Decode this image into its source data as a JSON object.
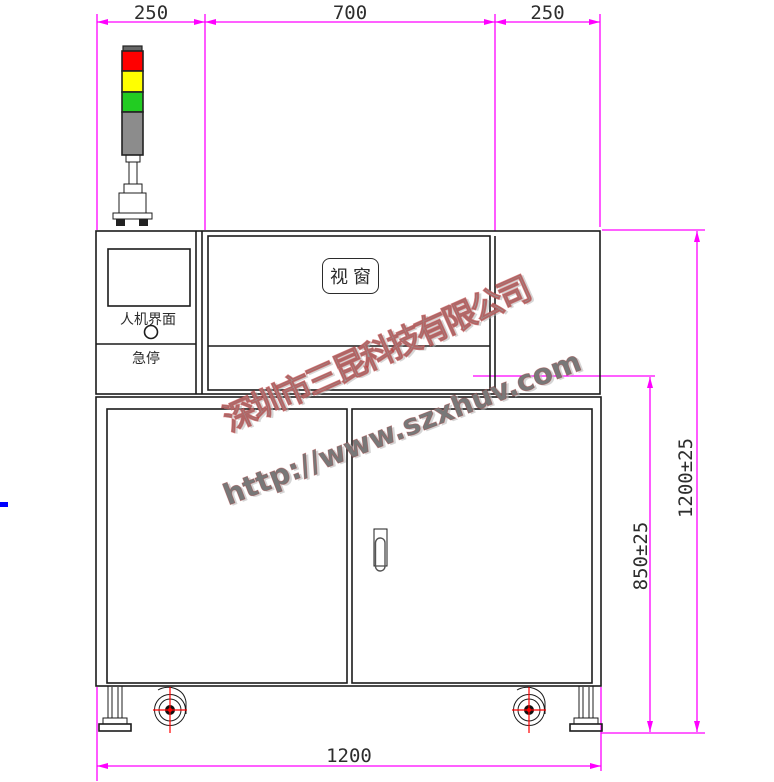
{
  "title": "UV machine front view CAD drawing",
  "colors": {
    "dim": "#FF00FF",
    "line": "#1c1c1c",
    "text": "#2e2e2e",
    "red": "#FF0000",
    "yellow": "#FFFF00",
    "green": "#22CC22",
    "gray": "#8C8C8C",
    "blue": "#0000FF",
    "watermark": "#9b9b9b"
  },
  "dimensions": {
    "top_left": "250",
    "top_mid": "700",
    "top_right": "250",
    "right_outer": "1200±25",
    "right_inner": "850±25",
    "bottom": "1200"
  },
  "labels": {
    "window": "视窗",
    "hmi": "人机界面",
    "estop": "急停"
  },
  "watermark": {
    "company": "深圳市三昆科技有限公司",
    "url": "http://www.szxhuv.com"
  },
  "tower": {
    "segments": [
      "red",
      "yellow",
      "green",
      "gray"
    ]
  }
}
